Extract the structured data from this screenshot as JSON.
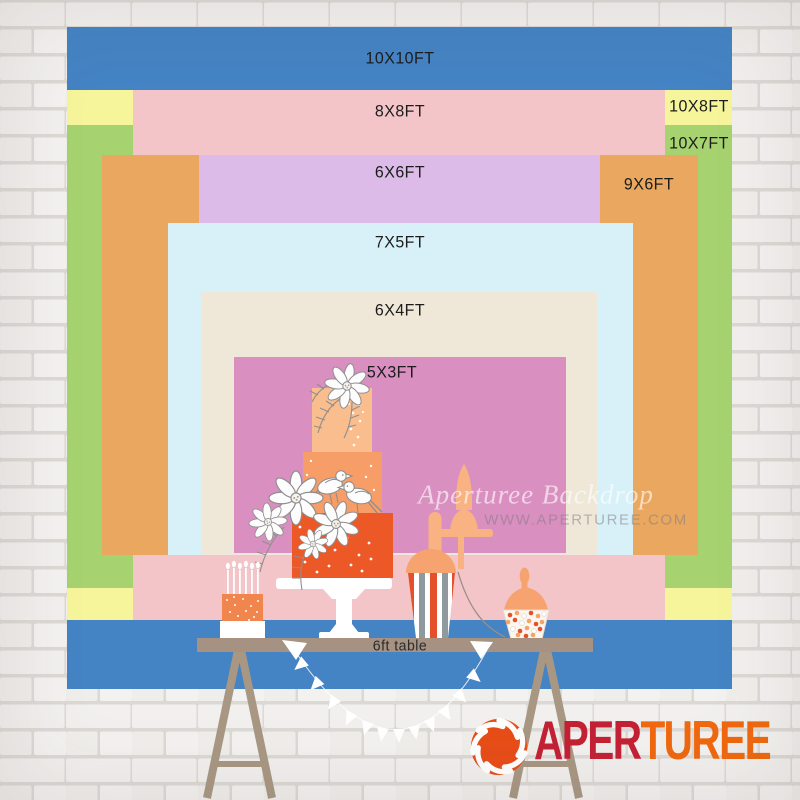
{
  "backdrop_chart": {
    "title_semantic": "backdrop size comparison chart",
    "sizes": [
      {
        "id": "10x10",
        "label": "10X10FT",
        "width_ft": 10,
        "height_ft": 10,
        "color": "#4483c4"
      },
      {
        "id": "10x8",
        "label": "10X8FT",
        "width_ft": 10,
        "height_ft": 8,
        "color": "#f6f59b"
      },
      {
        "id": "10x7",
        "label": "10X7FT",
        "width_ft": 10,
        "height_ft": 7,
        "color": "#a6d36f"
      },
      {
        "id": "8x8",
        "label": "8X8FT",
        "width_ft": 8,
        "height_ft": 8,
        "color": "#f3c5c8"
      },
      {
        "id": "9x6",
        "label": "9X6FT",
        "width_ft": 9,
        "height_ft": 6,
        "color": "#e9a75f"
      },
      {
        "id": "6x6",
        "label": "6X6FT",
        "width_ft": 6,
        "height_ft": 6,
        "color": "#dcbbe8"
      },
      {
        "id": "7x5",
        "label": "7X5FT",
        "width_ft": 7,
        "height_ft": 5,
        "color": "#d8f1f8"
      },
      {
        "id": "6x4",
        "label": "6X4FT",
        "width_ft": 6,
        "height_ft": 4,
        "color": "#efe8d9"
      },
      {
        "id": "5x3",
        "label": "5X3FT",
        "width_ft": 5,
        "height_ft": 3,
        "color": "#d98fc0"
      }
    ],
    "table_label": "6ft table"
  },
  "watermark": {
    "title": "Aperturee Backdrop",
    "url": "WWW.APERTUREE.COM"
  },
  "logo": {
    "brand_part1": "APER",
    "brand_part2": "TUREE",
    "color_part1": "#c42135",
    "color_part2": "#f0680f",
    "icon": "aperture-icon",
    "icon_color": "#e84d17"
  }
}
